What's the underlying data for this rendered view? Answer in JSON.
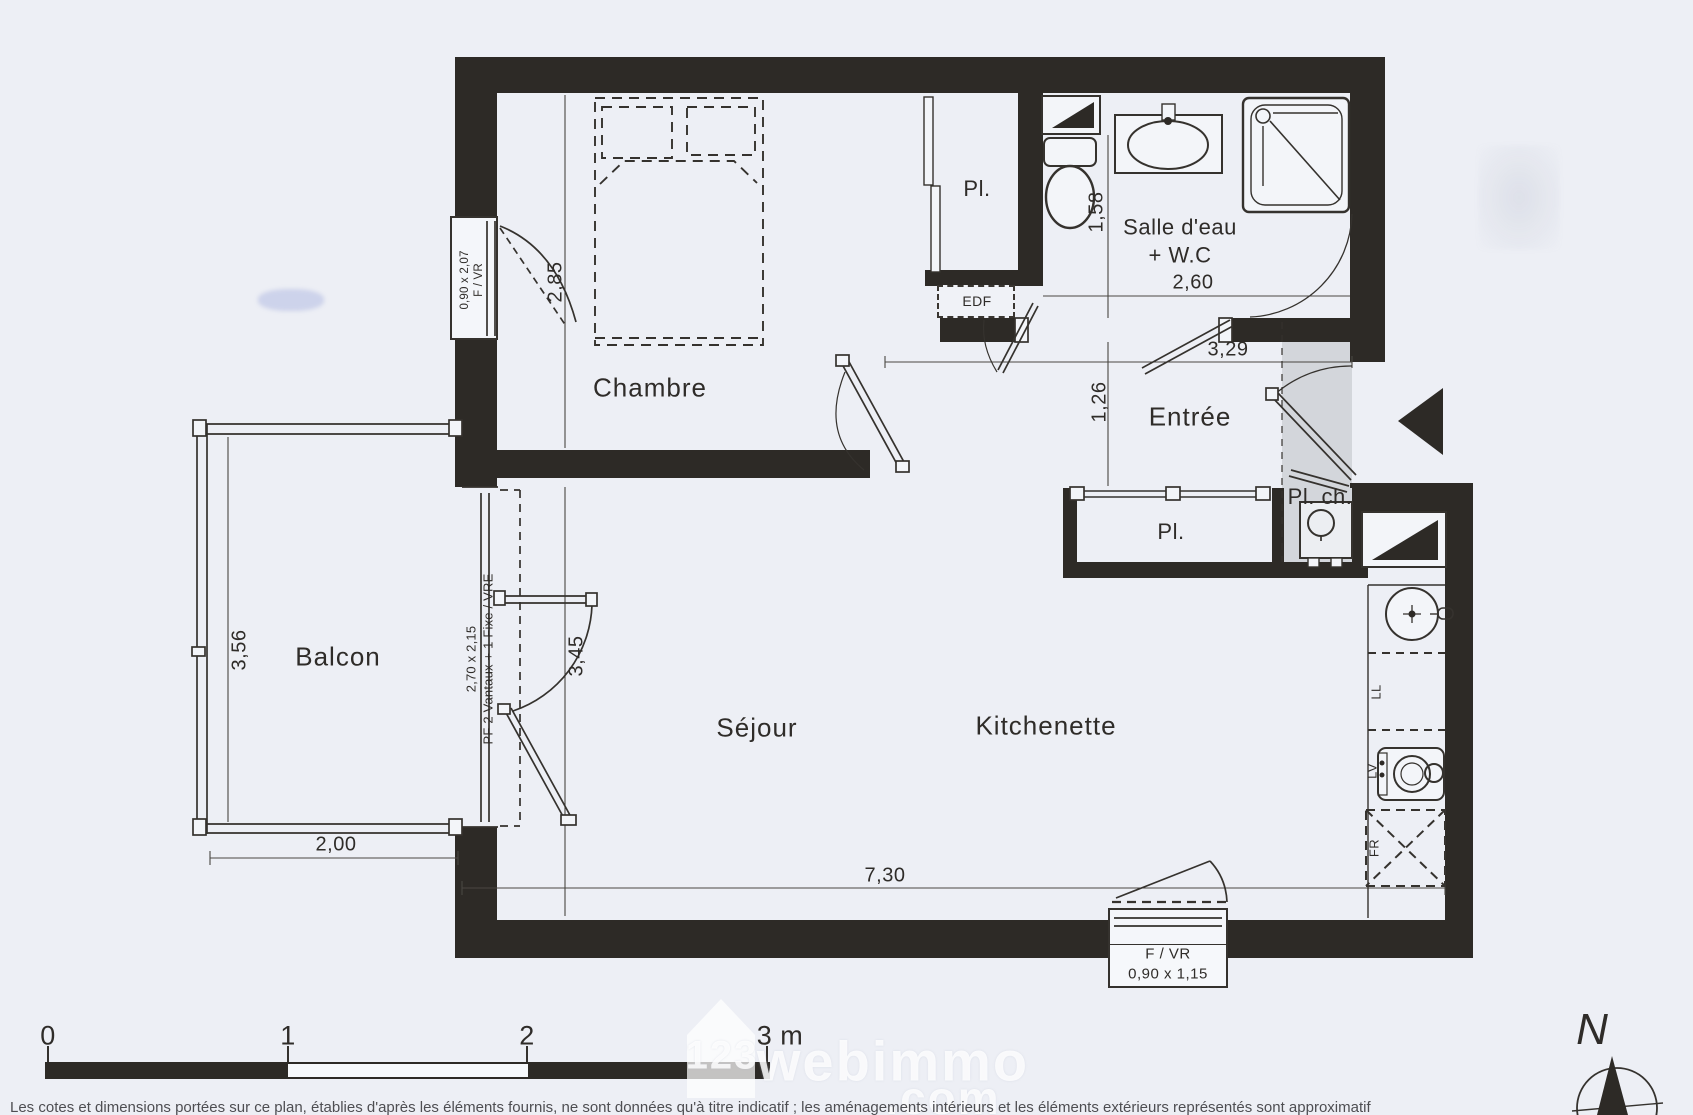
{
  "rooms": {
    "chambre": {
      "name": "Chambre"
    },
    "balcon": {
      "name": "Balcon"
    },
    "sejour": {
      "name": "Séjour"
    },
    "kitchenette": {
      "name": "Kitchenette"
    },
    "entree": {
      "name": "Entrée"
    },
    "salle_eau": {
      "line1": "Salle d'eau",
      "line2": "+ W.C"
    },
    "placard_chambre": {
      "name": "Pl."
    },
    "placard_sejour": {
      "name": "Pl."
    },
    "placard_chaudiere": {
      "name": "Pl. ch."
    },
    "edf": {
      "name": "EDF"
    }
  },
  "dimensions": {
    "chambre_depth": "2,85",
    "balcon_depth": "3,56",
    "balcon_width": "2,00",
    "sejour_depth": "3,45",
    "sejour_width": "7,30",
    "salle_eau_depth": "1,58",
    "salle_eau_width": "2,60",
    "hall_width": "3,29",
    "entree_depth": "1,26"
  },
  "windows": {
    "chambre_size": "0,90 x 2,07",
    "chambre_type": "F / VR",
    "sejour_size": "2,70 x 2,15",
    "sejour_type": "PF 2 Vantaux + 1 Fixe / VRE",
    "cuisine_type": "F / VR",
    "cuisine_size": "0,90 x 1,15"
  },
  "appliances": {
    "lave_linge": "LL",
    "lave_vaisselle": "LV",
    "refrigerateur": "FR"
  },
  "scale_bar": {
    "t0": "0",
    "t1": "1",
    "t2": "2",
    "t3": "3 m"
  },
  "compass": {
    "north": "N"
  },
  "watermark": {
    "prefix": "123",
    "name": "webimmo",
    "suffix": ".com"
  },
  "disclaimer": "Les cotes et dimensions portées sur ce plan, établies d'après les éléments fournis, ne sont données qu'à titre indicatif ; les aménagements intérieurs et les éléments extérieurs représentés sont approximatif"
}
